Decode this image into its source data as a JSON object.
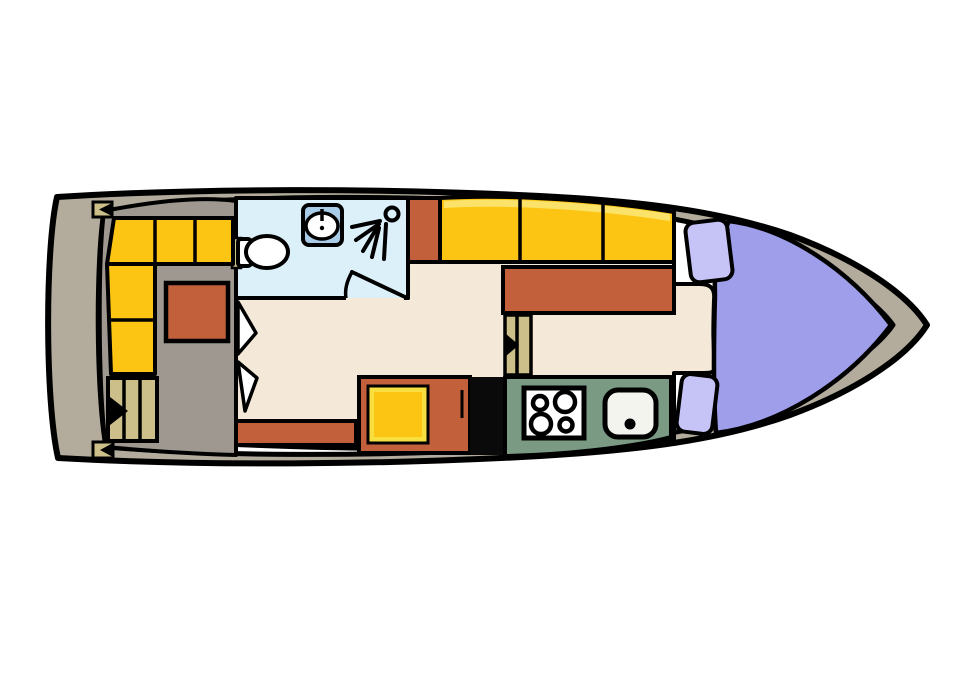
{
  "diagram": {
    "kind": "boat-floor-plan",
    "orientation": "bow-right",
    "icons": [
      "toilet-icon",
      "washbasin-icon",
      "shower-icon",
      "stove-burners-icon",
      "kitchen-sink-icon",
      "stairs-down-icon",
      "stairs-up-icon",
      "boarding-gate-icon",
      "door-swing-icon"
    ]
  },
  "colors": {
    "canvas": "#ffffff",
    "outline": "#000000",
    "hull": "#b3ac9d",
    "deck_gray": "#9e9890",
    "floor_cream": "#f4e8d9",
    "bathroom_blue": "#dcf0fa",
    "sink_unit_blue": "#a9cce8",
    "bench_yellow": "#fdc513",
    "bench_highlight": "#fbe36a",
    "tv_frame_yellow": "#f6df3e",
    "furniture_orange": "#c2603c",
    "kitchen_green": "#7a9a84",
    "berth_lavender": "#9f9eea",
    "pillow_lavender": "#c6c4f6",
    "steps_tan": "#cdbf8a",
    "fixture_white": "#ffffff",
    "sink_white": "#f4f4ef",
    "unit_black": "#0a0a0a"
  }
}
